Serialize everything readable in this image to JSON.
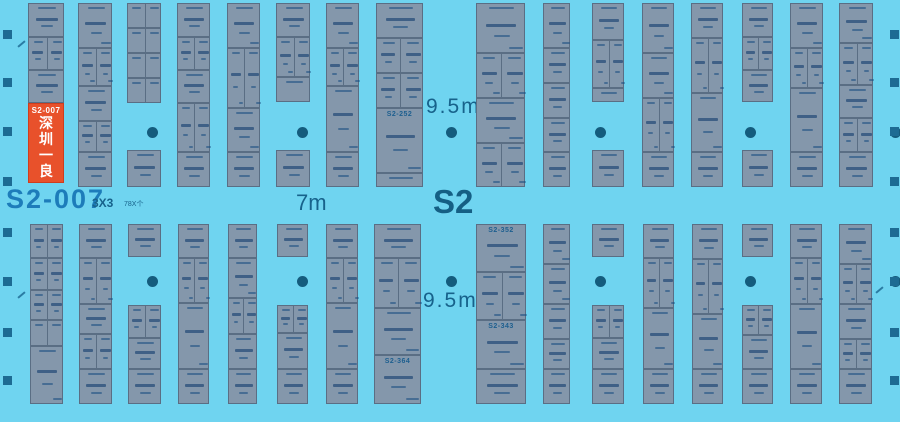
{
  "labels": {
    "big_booth_id": "S2-007",
    "size_hint": "3X3",
    "count_hint": "78X个",
    "aisle_width_mid": "7m",
    "hall_id": "S2",
    "aisle_width_top": "9.5m",
    "aisle_width_bottom": "9.5m"
  },
  "highlight_booth": {
    "id": "S2-007",
    "name": "深圳一良"
  },
  "colors": {
    "background": "#6fd4f0",
    "booth_fill": "#8497ab",
    "booth_border": "#5a6e84",
    "highlight_fill": "#e8512b",
    "label_blue": "#17628b",
    "big_id_blue": "#1d7cba",
    "pillar": "#145c7d",
    "wall": "#1d6b93"
  },
  "strips_top": [
    {
      "x": 28,
      "w": 36,
      "segs": [
        [
          34,
          1
        ],
        [
          33,
          2
        ],
        [
          33,
          1
        ]
      ]
    },
    {
      "x": 78,
      "w": 34,
      "segs": [
        [
          45,
          1
        ],
        [
          38,
          2
        ],
        [
          35,
          1
        ],
        [
          31,
          2
        ],
        [
          35,
          1
        ]
      ]
    },
    {
      "x": 127,
      "w": 34,
      "segs": [
        [
          25,
          2
        ],
        [
          25,
          2
        ],
        [
          25,
          2
        ],
        [
          25,
          2
        ],
        [
          47,
          0
        ],
        [
          37,
          1
        ]
      ]
    },
    {
      "x": 177,
      "w": 33,
      "segs": [
        [
          34,
          1
        ],
        [
          33,
          2
        ],
        [
          33,
          1
        ],
        [
          49,
          2
        ],
        [
          35,
          1
        ]
      ]
    },
    {
      "x": 227,
      "w": 33,
      "segs": [
        [
          45,
          1
        ],
        [
          60,
          2
        ],
        [
          44,
          1
        ],
        [
          35,
          1
        ]
      ]
    },
    {
      "x": 276,
      "w": 34,
      "segs": [
        [
          34,
          1
        ],
        [
          40,
          2
        ],
        [
          25,
          1
        ],
        [
          48,
          0
        ],
        [
          37,
          1
        ]
      ]
    },
    {
      "x": 326,
      "w": 33,
      "segs": [
        [
          45,
          1
        ],
        [
          38,
          2
        ],
        [
          66,
          1
        ],
        [
          35,
          1
        ]
      ]
    },
    {
      "x": 376,
      "w": 47,
      "segs": [
        [
          35,
          1
        ],
        [
          35,
          2
        ],
        [
          35,
          2
        ],
        [
          65,
          1,
          "S2-252"
        ],
        [
          14,
          1
        ]
      ]
    },
    {
      "x": 476,
      "w": 49,
      "segs": [
        [
          50,
          1
        ],
        [
          45,
          2
        ],
        [
          45,
          1
        ],
        [
          44,
          2
        ]
      ]
    },
    {
      "x": 543,
      "w": 27,
      "segs": [
        [
          45,
          1
        ],
        [
          35,
          1
        ],
        [
          35,
          1
        ],
        [
          34,
          1
        ],
        [
          35,
          1
        ]
      ]
    },
    {
      "x": 592,
      "w": 32,
      "segs": [
        [
          37,
          1
        ],
        [
          48,
          2
        ],
        [
          14,
          1
        ],
        [
          48,
          0
        ],
        [
          37,
          1
        ]
      ]
    },
    {
      "x": 642,
      "w": 32,
      "segs": [
        [
          50,
          1
        ],
        [
          45,
          1
        ],
        [
          54,
          2
        ],
        [
          35,
          1
        ]
      ]
    },
    {
      "x": 691,
      "w": 32,
      "segs": [
        [
          35,
          1
        ],
        [
          55,
          2
        ],
        [
          59,
          1
        ],
        [
          35,
          1
        ]
      ]
    },
    {
      "x": 742,
      "w": 31,
      "segs": [
        [
          34,
          1
        ],
        [
          33,
          2
        ],
        [
          32,
          1
        ],
        [
          48,
          0
        ],
        [
          37,
          1
        ]
      ]
    },
    {
      "x": 790,
      "w": 33,
      "segs": [
        [
          45,
          1
        ],
        [
          40,
          2
        ],
        [
          64,
          1
        ],
        [
          35,
          1
        ]
      ]
    },
    {
      "x": 839,
      "w": 34,
      "segs": [
        [
          40,
          1
        ],
        [
          42,
          2
        ],
        [
          33,
          1
        ],
        [
          34,
          2
        ],
        [
          35,
          1
        ]
      ]
    }
  ],
  "strips_bottom": [
    {
      "x": 30,
      "w": 33,
      "segs": [
        [
          34,
          2
        ],
        [
          32,
          2
        ],
        [
          30,
          2
        ],
        [
          26,
          2
        ],
        [
          58,
          1
        ]
      ]
    },
    {
      "x": 79,
      "w": 33,
      "segs": [
        [
          34,
          1
        ],
        [
          46,
          2
        ],
        [
          30,
          1
        ],
        [
          35,
          2
        ],
        [
          35,
          1
        ]
      ]
    },
    {
      "x": 128,
      "w": 33,
      "segs": [
        [
          33,
          1
        ],
        [
          48,
          0
        ],
        [
          33,
          2
        ],
        [
          31,
          1
        ],
        [
          35,
          1
        ]
      ]
    },
    {
      "x": 178,
      "w": 31,
      "segs": [
        [
          34,
          1
        ],
        [
          45,
          2
        ],
        [
          66,
          1
        ],
        [
          35,
          1
        ]
      ]
    },
    {
      "x": 228,
      "w": 29,
      "segs": [
        [
          34,
          1
        ],
        [
          40,
          1
        ],
        [
          36,
          2
        ],
        [
          35,
          1
        ],
        [
          35,
          1
        ]
      ]
    },
    {
      "x": 277,
      "w": 31,
      "segs": [
        [
          33,
          1
        ],
        [
          48,
          0
        ],
        [
          28,
          2
        ],
        [
          36,
          1
        ],
        [
          35,
          1
        ]
      ]
    },
    {
      "x": 326,
      "w": 32,
      "segs": [
        [
          34,
          1
        ],
        [
          45,
          2
        ],
        [
          66,
          1
        ],
        [
          35,
          1
        ]
      ]
    },
    {
      "x": 374,
      "w": 47,
      "segs": [
        [
          34,
          1
        ],
        [
          50,
          2
        ],
        [
          47,
          1
        ],
        [
          49,
          1,
          "S2-364"
        ]
      ]
    },
    {
      "x": 476,
      "w": 50,
      "segs": [
        [
          48,
          1,
          "S2-352"
        ],
        [
          48,
          2
        ],
        [
          49,
          1,
          "S2-343"
        ],
        [
          35,
          1
        ]
      ]
    },
    {
      "x": 543,
      "w": 27,
      "segs": [
        [
          40,
          1
        ],
        [
          40,
          1
        ],
        [
          35,
          1
        ],
        [
          30,
          1
        ],
        [
          35,
          1
        ]
      ]
    },
    {
      "x": 592,
      "w": 32,
      "segs": [
        [
          33,
          1
        ],
        [
          48,
          0
        ],
        [
          33,
          2
        ],
        [
          31,
          1
        ],
        [
          35,
          1
        ]
      ]
    },
    {
      "x": 643,
      "w": 31,
      "segs": [
        [
          34,
          1
        ],
        [
          50,
          2
        ],
        [
          61,
          1
        ],
        [
          35,
          1
        ]
      ]
    },
    {
      "x": 692,
      "w": 31,
      "segs": [
        [
          35,
          1
        ],
        [
          55,
          2
        ],
        [
          55,
          1
        ],
        [
          35,
          1
        ]
      ]
    },
    {
      "x": 742,
      "w": 31,
      "segs": [
        [
          33,
          1
        ],
        [
          48,
          0
        ],
        [
          30,
          2
        ],
        [
          34,
          1
        ],
        [
          35,
          1
        ]
      ]
    },
    {
      "x": 790,
      "w": 32,
      "segs": [
        [
          34,
          1
        ],
        [
          46,
          2
        ],
        [
          65,
          1
        ],
        [
          35,
          1
        ]
      ]
    },
    {
      "x": 839,
      "w": 33,
      "segs": [
        [
          40,
          1
        ],
        [
          40,
          2
        ],
        [
          35,
          1
        ],
        [
          30,
          2
        ],
        [
          35,
          1
        ]
      ]
    }
  ],
  "strip_top_y": 3,
  "strip_bottom_y": 224,
  "pillars": {
    "xs": [
      152,
      302,
      451,
      600,
      750,
      895
    ],
    "rows": [
      132,
      281
    ]
  },
  "wall_squares": {
    "ys": [
      30,
      78,
      127,
      177,
      228,
      277,
      328,
      376
    ],
    "left_x": 3,
    "right_x": 890
  },
  "door_marks": [
    {
      "x": 17,
      "y": 43
    },
    {
      "x": 17,
      "y": 294
    },
    {
      "x": 875,
      "y": 289
    }
  ]
}
